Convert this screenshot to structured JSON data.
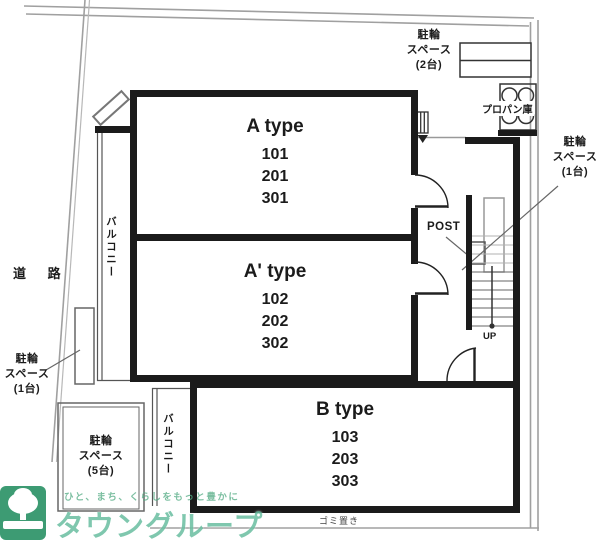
{
  "plan": {
    "road": "道 路",
    "apartments": [
      {
        "type": "A type",
        "units": [
          "101",
          "201",
          "301"
        ]
      },
      {
        "type": "A' type",
        "units": [
          "102",
          "202",
          "302"
        ]
      },
      {
        "type": "B type",
        "units": [
          "103",
          "203",
          "303"
        ]
      }
    ],
    "balcony": "バルコニー",
    "bike_spaces": {
      "two": [
        "駐輪",
        "スペース",
        "(2台)"
      ],
      "one_right": [
        "駐輪",
        "スペース",
        "(1台)"
      ],
      "one_left": [
        "駐輪",
        "スペース",
        "(1台)"
      ],
      "five": [
        "駐輪",
        "スペース",
        "(5台)"
      ]
    },
    "propane": "プロパン庫",
    "post": "POST",
    "up": "UP",
    "note": "ゴミ置き"
  },
  "watermark": {
    "slogan": "ひと、まち、くらしをもっと豊かに",
    "brand": "タウングループ"
  },
  "colors": {
    "wall": "#1b1b1b",
    "boundary": "#a0a0a0",
    "watermark_green": "#4db28f",
    "logo_green": "#2f9469"
  }
}
